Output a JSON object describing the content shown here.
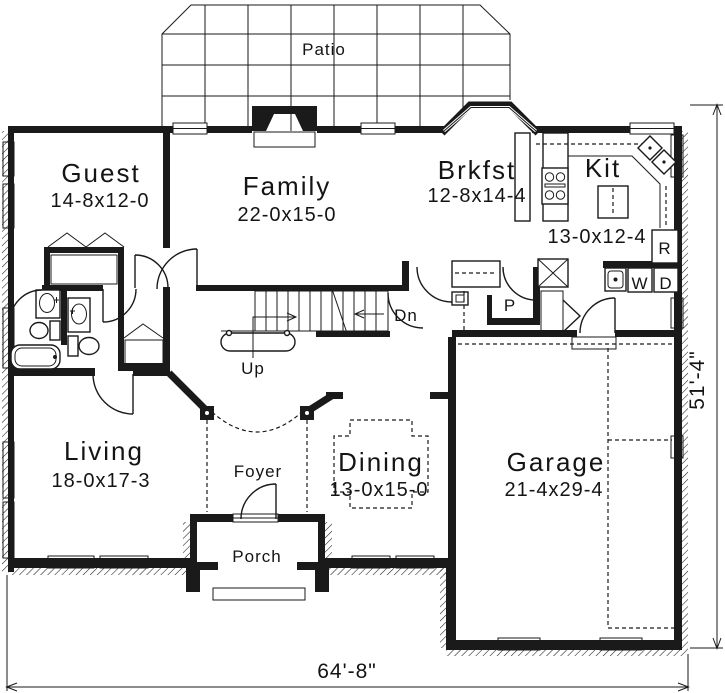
{
  "plan": {
    "labels": {
      "patio": "Patio",
      "foyer": "Foyer",
      "porch": "Porch",
      "up": "Up",
      "down": "Dn",
      "pantry": "P",
      "refrigerator": "R",
      "washer": "W",
      "dryer": "D"
    },
    "rooms": {
      "guest": {
        "name": "Guest",
        "size": "14-8x12-0"
      },
      "family": {
        "name": "Family",
        "size": "22-0x15-0"
      },
      "breakfast": {
        "name": "Brkfst",
        "size": "12-8x14-4"
      },
      "kitchen": {
        "name": "Kit",
        "size": "13-0x12-4"
      },
      "living": {
        "name": "Living",
        "size": "18-0x17-3"
      },
      "dining": {
        "name": "Dining",
        "size": "13-0x15-0"
      },
      "garage": {
        "name": "Garage",
        "size": "21-4x29-4"
      }
    },
    "overall": {
      "width": "64'-8\"",
      "depth": "51'-4\""
    },
    "colors": {
      "ink": "#1a1a1a",
      "paper": "#ffffff"
    }
  }
}
